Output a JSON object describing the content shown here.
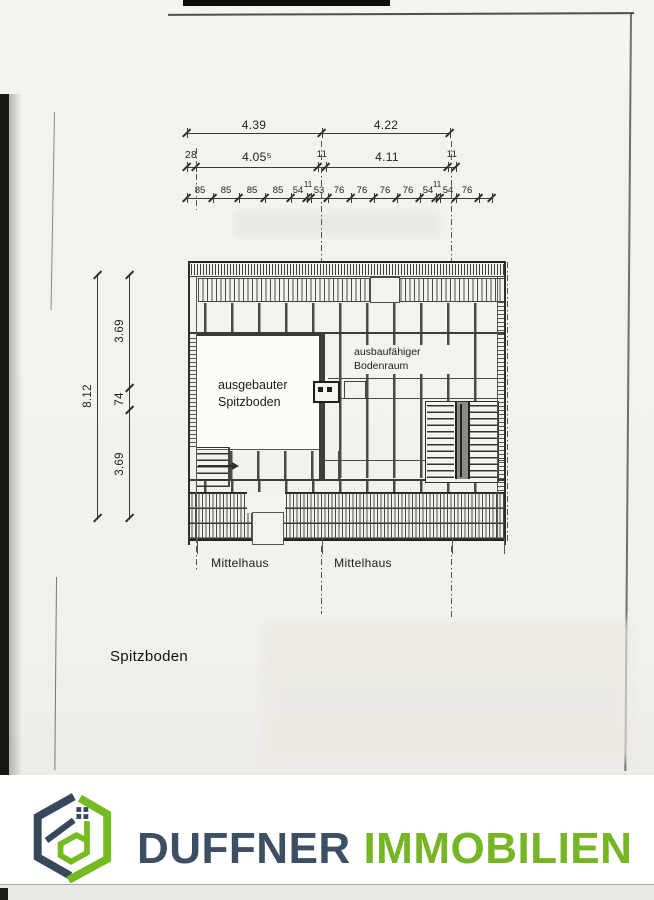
{
  "top_dimensions": {
    "row1": [
      "4.39",
      "4.22"
    ],
    "row2": [
      "28",
      "4.05⁵",
      "11",
      "4.11",
      "11"
    ],
    "row3": [
      "85",
      "85",
      "85",
      "85",
      "54",
      "11",
      "53",
      "76",
      "76",
      "76",
      "76",
      "54",
      "11",
      "54",
      "76"
    ]
  },
  "left_dimensions": {
    "total": "8.12",
    "segments": [
      "3.69",
      "74",
      "3.69"
    ]
  },
  "plan_labels": {
    "left_room_line1": "ausgebauter",
    "left_room_line2": "Spitzboden",
    "right_room_line1": "ausbaufähiger",
    "right_room_line2": "Bodenraum",
    "axis_left": "Mittelhaus",
    "axis_right": "Mittelhaus"
  },
  "caption": "Spitzboden",
  "logo": {
    "word1": "DUFFNER",
    "word2": "IMMOBILIEN",
    "dark_color": "#3d4f63",
    "green_color": "#76b524"
  }
}
